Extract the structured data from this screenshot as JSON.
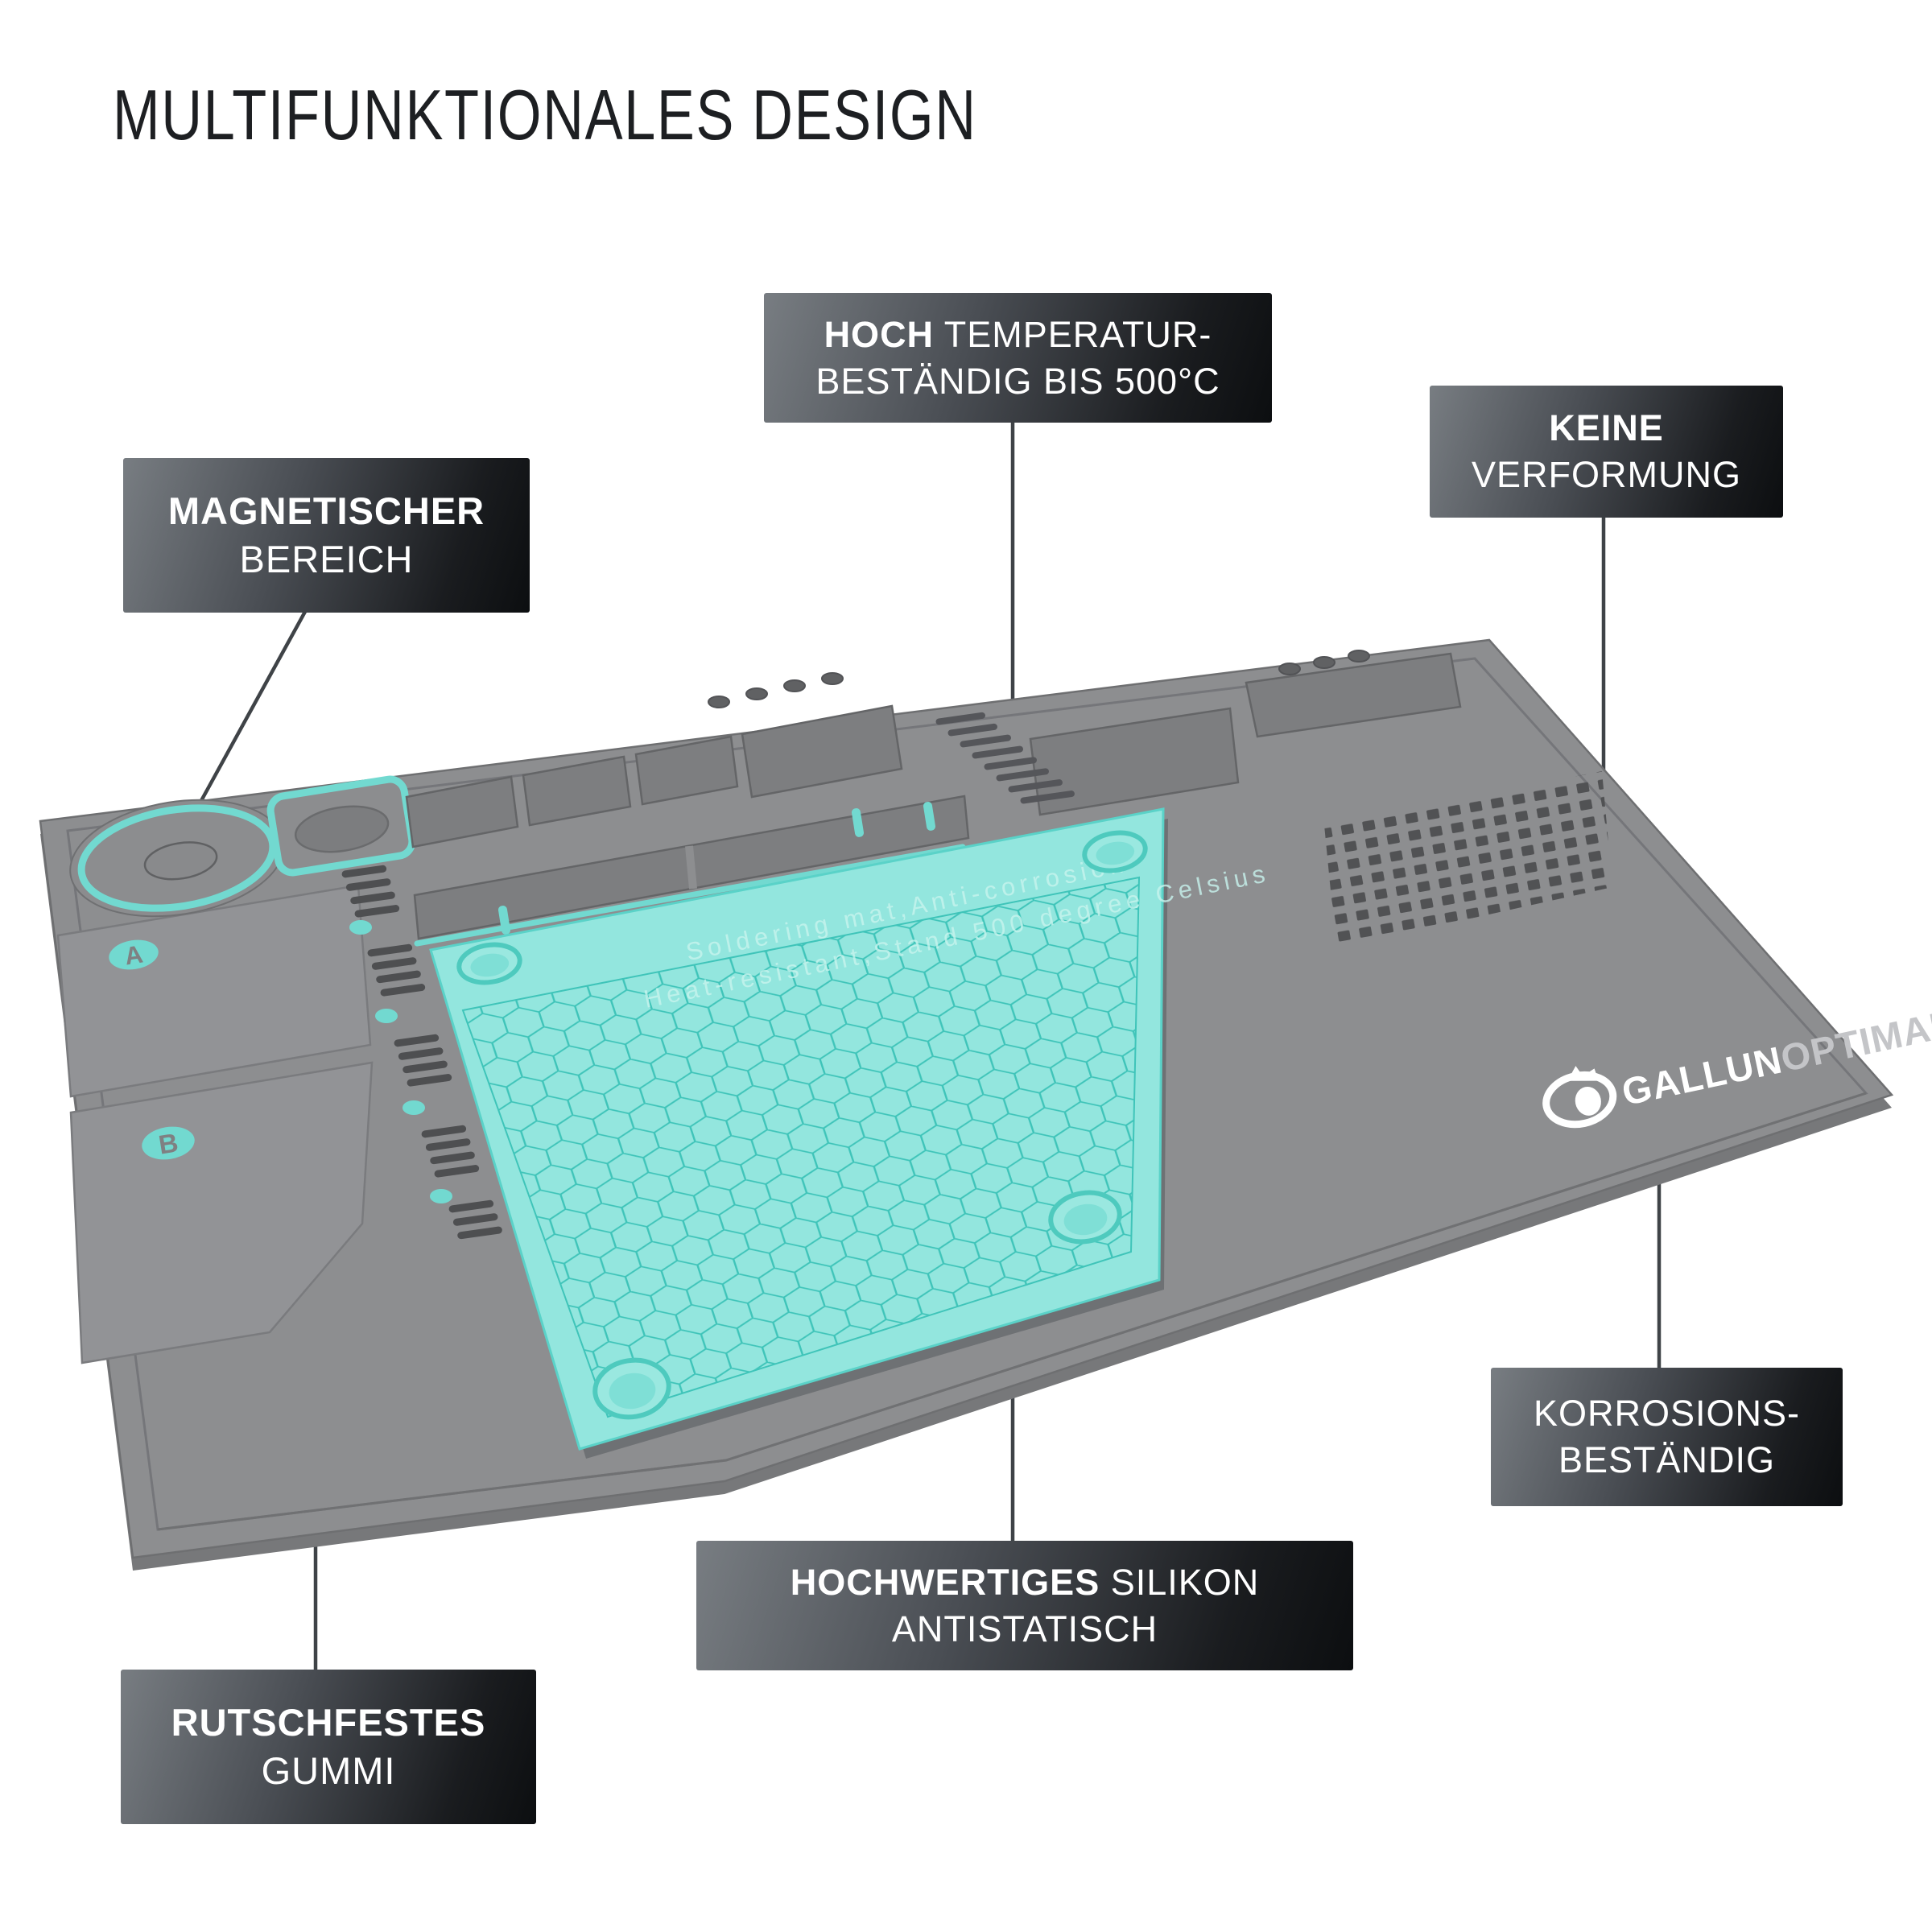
{
  "title": "MULTIFUNKTIONALES DESIGN",
  "callouts": {
    "magnetic": {
      "line1": "MAGNETISCHER",
      "line2": "BEREICH"
    },
    "temperature": {
      "line1_bold": "HOCH",
      "line1_rest": " TEMPERATUR-",
      "line2": "BESTÄNDIG BIS 500°C"
    },
    "deformation": {
      "line1": "KEINE",
      "line2": "VERFORMUNG"
    },
    "corrosion": {
      "line1": "KORROSIONS-",
      "line2": "BESTÄNDIG"
    },
    "silicone": {
      "line1_bold": "HOCHWERTIGES",
      "line1_rest": " SILIKON",
      "line2": "ANTISTATISCH"
    },
    "rubber": {
      "line1": "RUTSCHFESTES",
      "line2": "GUMMI"
    }
  },
  "mat": {
    "brand": {
      "part1": "GALLUN",
      "part2": "OPTIMAL"
    },
    "embossed_line1": "Soldering mat,Anti-corrosion",
    "embossed_line2": "Heat-resistant,Stand 500 degree Celsius",
    "zone_label_a": "A",
    "zone_label_b": "B",
    "colors": {
      "accent_teal": "#72d9d0",
      "mat_teal": "#93e6de",
      "hex_line": "#3fc4b9",
      "mat_gray": "#8d8e90",
      "recess_gray": "#7d7e80",
      "slot_dark": "#4e4f51",
      "callout_dark": "#0c0e10",
      "callout_light": "#787d82",
      "line_color": "#3f4347"
    }
  }
}
